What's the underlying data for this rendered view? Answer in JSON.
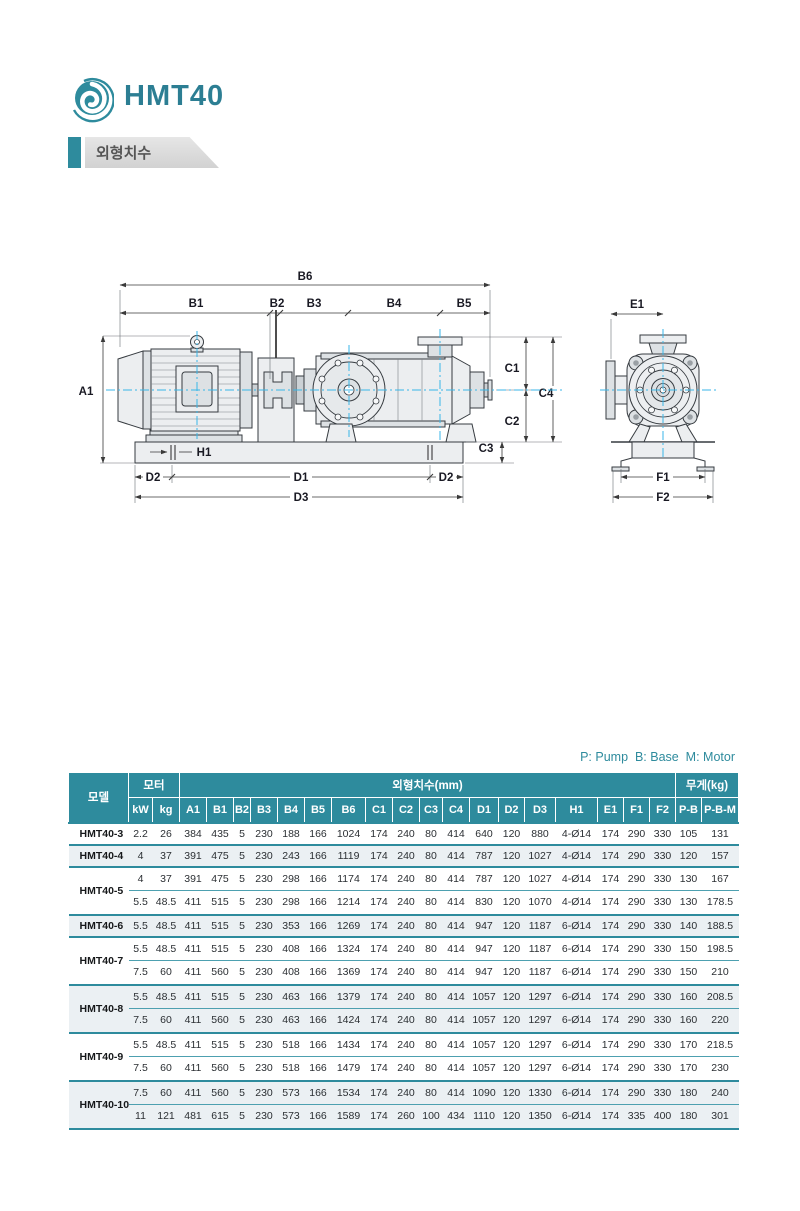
{
  "colors": {
    "accent": "#2E8B9D",
    "accent_dark": "#2C7E93",
    "alt_row": "#EBF0F3",
    "centerline": "#38B6E8"
  },
  "header": {
    "title": "HMT40"
  },
  "section": {
    "label": "외형치수"
  },
  "drawing": {
    "labels": {
      "a1": "A1",
      "b1": "B1",
      "b2": "B2",
      "b3": "B3",
      "b4": "B4",
      "b5": "B5",
      "b6": "B6",
      "c1": "C1",
      "c2": "C2",
      "c3": "C3",
      "c4": "C4",
      "d1": "D1",
      "d2": "D2",
      "d3": "D3",
      "h1": "H1",
      "e1": "E1",
      "f1": "F1",
      "f2": "F2"
    }
  },
  "table": {
    "legend": "P: Pump  B: Base  M: Motor",
    "head_groups": [
      {
        "label": "모델",
        "rowspan": 2,
        "colspan": 1
      },
      {
        "label": "모터",
        "rowspan": 1,
        "colspan": 2
      },
      {
        "label": "외형치수(mm)",
        "rowspan": 1,
        "colspan": 18
      },
      {
        "label": "무게(kg)",
        "rowspan": 1,
        "colspan": 2
      }
    ],
    "subheaders": [
      "kW",
      "kg",
      "A1",
      "B1",
      "B2",
      "B3",
      "B4",
      "B5",
      "B6",
      "C1",
      "C2",
      "C3",
      "C4",
      "D1",
      "D2",
      "D3",
      "H1",
      "E1",
      "F1",
      "F2",
      "P-B",
      "P-B-M"
    ],
    "groups": [
      {
        "model": "HMT40-3",
        "rows": [
          [
            "2.2",
            "26",
            "384",
            "435",
            "5",
            "230",
            "188",
            "166",
            "1024",
            "174",
            "240",
            "80",
            "414",
            "640",
            "120",
            "880",
            "4-Ø14",
            "174",
            "290",
            "330",
            "105",
            "131"
          ]
        ]
      },
      {
        "model": "HMT40-4",
        "rows": [
          [
            "4",
            "37",
            "391",
            "475",
            "5",
            "230",
            "243",
            "166",
            "1119",
            "174",
            "240",
            "80",
            "414",
            "787",
            "120",
            "1027",
            "4-Ø14",
            "174",
            "290",
            "330",
            "120",
            "157"
          ]
        ]
      },
      {
        "model": "HMT40-5",
        "rows": [
          [
            "4",
            "37",
            "391",
            "475",
            "5",
            "230",
            "298",
            "166",
            "1174",
            "174",
            "240",
            "80",
            "414",
            "787",
            "120",
            "1027",
            "4-Ø14",
            "174",
            "290",
            "330",
            "130",
            "167"
          ],
          [
            "5.5",
            "48.5",
            "411",
            "515",
            "5",
            "230",
            "298",
            "166",
            "1214",
            "174",
            "240",
            "80",
            "414",
            "830",
            "120",
            "1070",
            "4-Ø14",
            "174",
            "290",
            "330",
            "130",
            "178.5"
          ]
        ]
      },
      {
        "model": "HMT40-6",
        "rows": [
          [
            "5.5",
            "48.5",
            "411",
            "515",
            "5",
            "230",
            "353",
            "166",
            "1269",
            "174",
            "240",
            "80",
            "414",
            "947",
            "120",
            "1187",
            "6-Ø14",
            "174",
            "290",
            "330",
            "140",
            "188.5"
          ]
        ]
      },
      {
        "model": "HMT40-7",
        "rows": [
          [
            "5.5",
            "48.5",
            "411",
            "515",
            "5",
            "230",
            "408",
            "166",
            "1324",
            "174",
            "240",
            "80",
            "414",
            "947",
            "120",
            "1187",
            "6-Ø14",
            "174",
            "290",
            "330",
            "150",
            "198.5"
          ],
          [
            "7.5",
            "60",
            "411",
            "560",
            "5",
            "230",
            "408",
            "166",
            "1369",
            "174",
            "240",
            "80",
            "414",
            "947",
            "120",
            "1187",
            "6-Ø14",
            "174",
            "290",
            "330",
            "150",
            "210"
          ]
        ]
      },
      {
        "model": "HMT40-8",
        "rows": [
          [
            "5.5",
            "48.5",
            "411",
            "515",
            "5",
            "230",
            "463",
            "166",
            "1379",
            "174",
            "240",
            "80",
            "414",
            "1057",
            "120",
            "1297",
            "6-Ø14",
            "174",
            "290",
            "330",
            "160",
            "208.5"
          ],
          [
            "7.5",
            "60",
            "411",
            "560",
            "5",
            "230",
            "463",
            "166",
            "1424",
            "174",
            "240",
            "80",
            "414",
            "1057",
            "120",
            "1297",
            "6-Ø14",
            "174",
            "290",
            "330",
            "160",
            "220"
          ]
        ]
      },
      {
        "model": "HMT40-9",
        "rows": [
          [
            "5.5",
            "48.5",
            "411",
            "515",
            "5",
            "230",
            "518",
            "166",
            "1434",
            "174",
            "240",
            "80",
            "414",
            "1057",
            "120",
            "1297",
            "6-Ø14",
            "174",
            "290",
            "330",
            "170",
            "218.5"
          ],
          [
            "7.5",
            "60",
            "411",
            "560",
            "5",
            "230",
            "518",
            "166",
            "1479",
            "174",
            "240",
            "80",
            "414",
            "1057",
            "120",
            "1297",
            "6-Ø14",
            "174",
            "290",
            "330",
            "170",
            "230"
          ]
        ]
      },
      {
        "model": "HMT40-10",
        "rows": [
          [
            "7.5",
            "60",
            "411",
            "560",
            "5",
            "230",
            "573",
            "166",
            "1534",
            "174",
            "240",
            "80",
            "414",
            "1090",
            "120",
            "1330",
            "6-Ø14",
            "174",
            "290",
            "330",
            "180",
            "240"
          ],
          [
            "11",
            "121",
            "481",
            "615",
            "5",
            "230",
            "573",
            "166",
            "1589",
            "174",
            "260",
            "100",
            "434",
            "1110",
            "120",
            "1350",
            "6-Ø14",
            "174",
            "335",
            "400",
            "180",
            "301"
          ]
        ]
      }
    ]
  }
}
